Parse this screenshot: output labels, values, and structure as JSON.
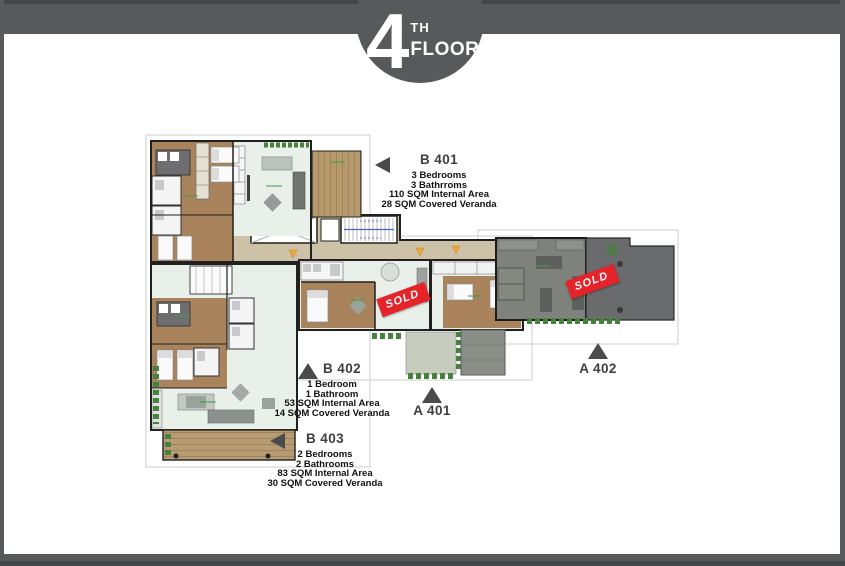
{
  "header": {
    "floor_number": "4",
    "floor_ordinal": "TH",
    "floor_word": "FLOOR"
  },
  "units": {
    "b401": {
      "label": "B 401",
      "pointer": "left",
      "details": [
        "3 Bedrooms",
        "3 Bathrroms",
        "110 SQM Internal Area",
        "28 SQM Covered Veranda"
      ]
    },
    "b402": {
      "label": "B 402",
      "pointer": "up",
      "details": [
        "1 Bedroom",
        "1 Bathroom",
        "53 SQM Internal Area",
        "14 SQM Covered Veranda"
      ]
    },
    "b403": {
      "label": "B 403",
      "pointer": "left",
      "details": [
        "2 Bedrooms",
        "2 Bathrooms",
        "83 SQM Internal Area",
        "30 SQM Covered Veranda"
      ]
    },
    "a401": {
      "label": "A 401",
      "pointer": "up",
      "details": []
    },
    "a402": {
      "label": "A 402",
      "pointer": "up",
      "details": []
    }
  },
  "badges": {
    "sold_1": "SOLD",
    "sold_2": "SOLD"
  },
  "colors": {
    "frame": "#58595b",
    "accent_red": "#e4232b",
    "triangle": "#4a4b4d",
    "floor_brown": "#a8835b",
    "floor_pale": "#e9efe9",
    "corridor_tan": "#cdc2a8",
    "veranda_wood": "#b69a6e",
    "sold_unit_gray": "#7e817c",
    "shrub_green": "#47813e"
  }
}
